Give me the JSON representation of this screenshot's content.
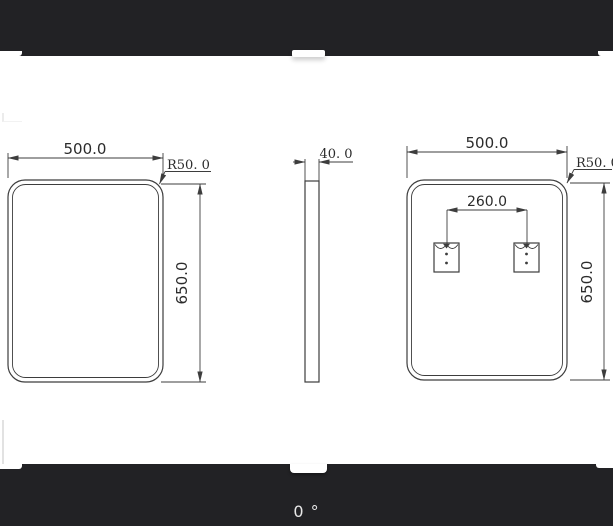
{
  "editor": {
    "rotation_label": "0 °",
    "colors": {
      "bar_background": "#222225",
      "canvas_background": "#ffffff",
      "line_color": "#3d3d3d",
      "dimension_text_color": "#2b2b2b",
      "rotation_text_color": "#e8e8e8"
    }
  },
  "drawing": {
    "front_view": {
      "width": "500.0",
      "height": "650.0",
      "corner_radius": "R50. 0"
    },
    "side_view": {
      "thickness": "40. 0"
    },
    "back_view": {
      "width": "500.0",
      "height": "650.0",
      "corner_radius": "R50. 0",
      "hanger_spacing": "260.0"
    }
  }
}
